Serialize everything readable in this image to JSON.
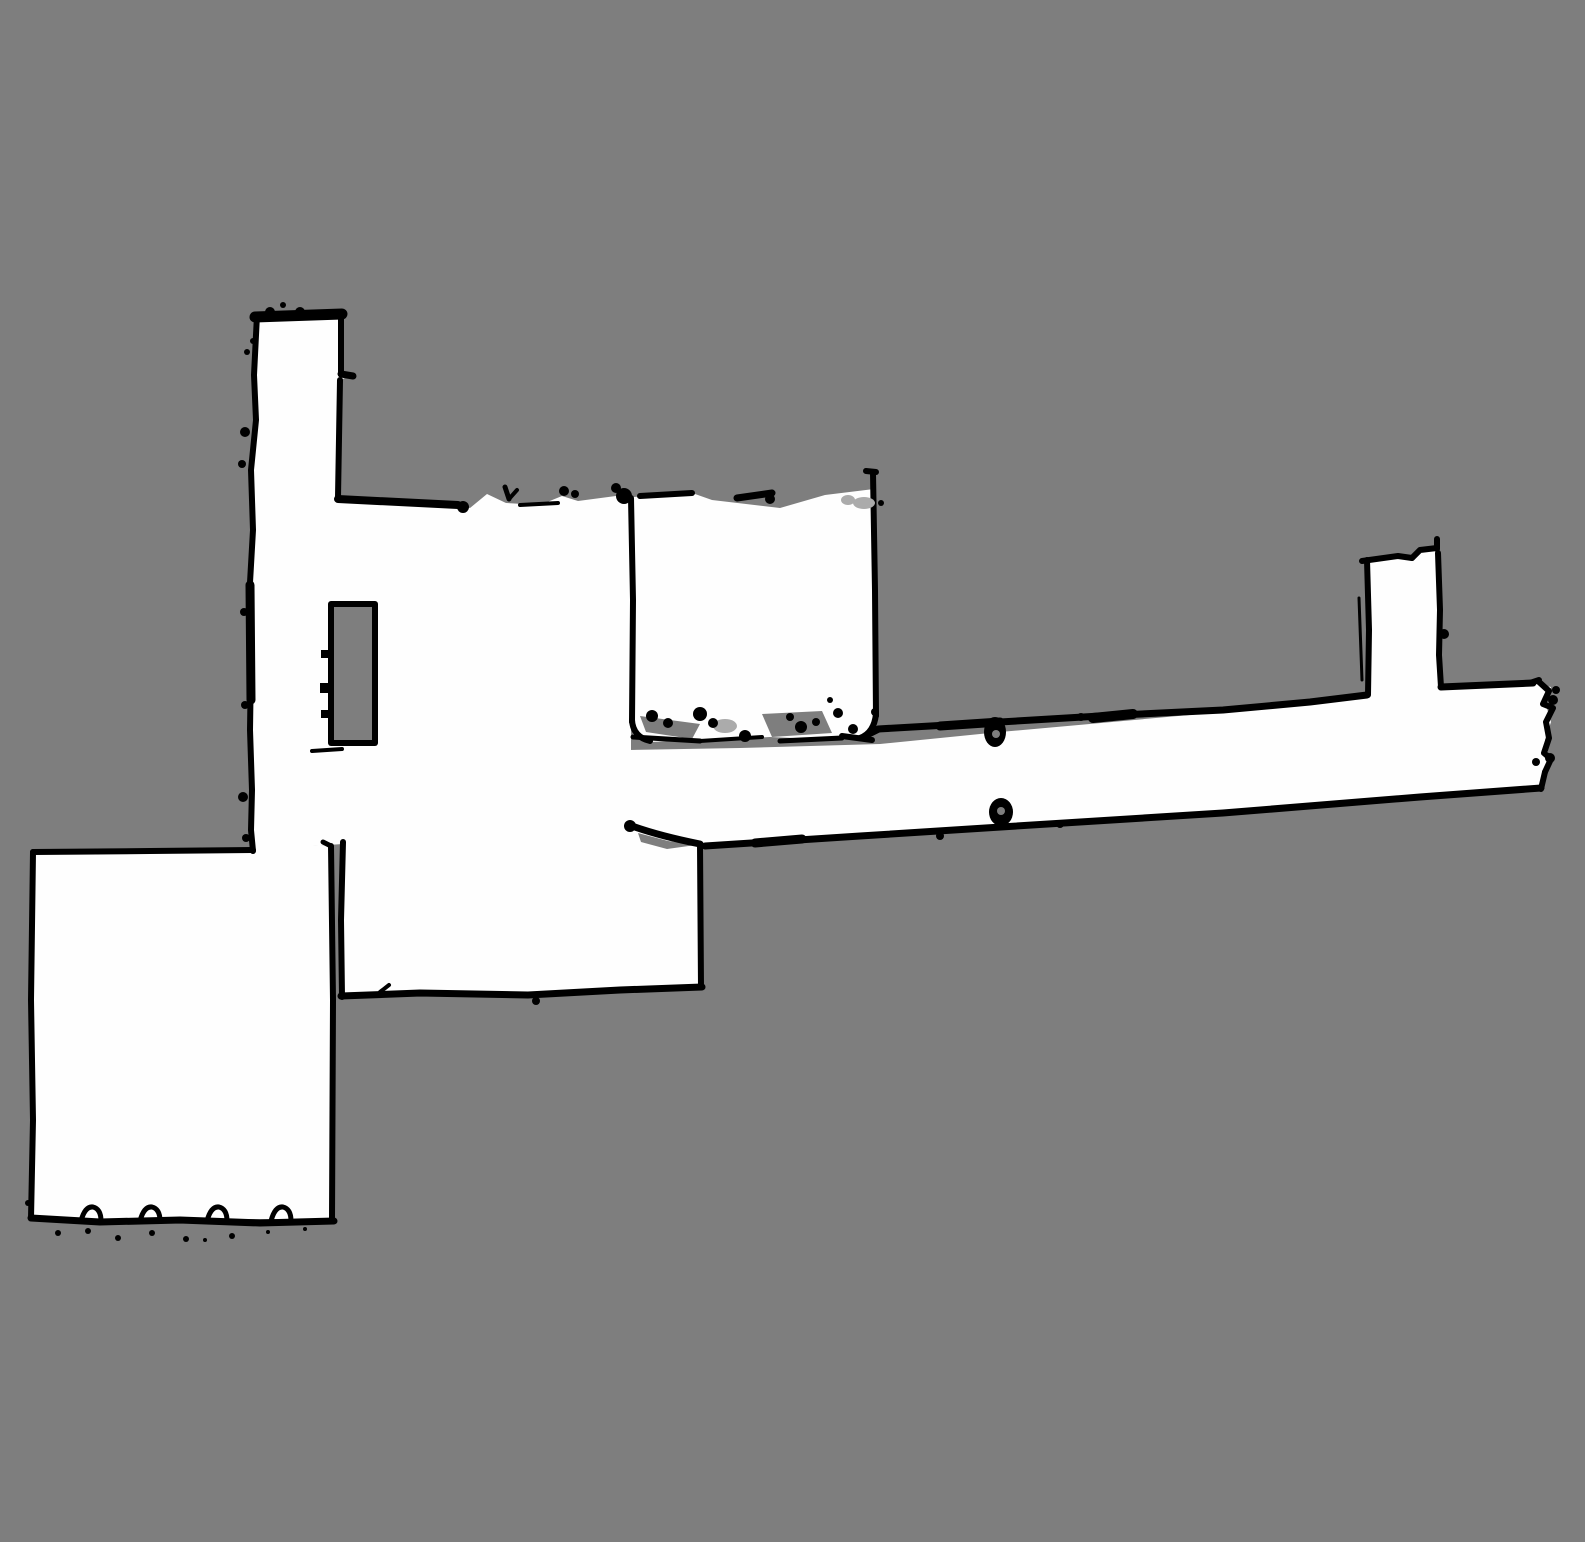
{
  "map": {
    "kind": "slam-occupancy-grid-map",
    "canvas": {
      "width": 1585,
      "height": 1542
    },
    "colors": {
      "unknown": "#7e7e7e",
      "free": "#fefefe",
      "occupied": "#000000",
      "smudge": "#ababab"
    },
    "legend": {
      "unknown": "unknown / unexplored",
      "free": "free space",
      "occupied": "wall / obstacle"
    },
    "regions": [
      {
        "id": "north-corridor",
        "desc": "narrow vertical corridor top-left",
        "bounds_px": "x255-341 y310-497"
      },
      {
        "id": "central-room",
        "desc": "large central free-space room",
        "bounds_px": "x250-633 y490-845"
      },
      {
        "id": "upper-room",
        "desc": "square room right of central room",
        "bounds_px": "x630-877 y472-745"
      },
      {
        "id": "lower-middle-room",
        "desc": "room below central room",
        "bounds_px": "x340-703 y825-997"
      },
      {
        "id": "bottom-left-room",
        "desc": "large rectangular room bottom-left",
        "bounds_px": "x30-334 y845-1222"
      },
      {
        "id": "east-corridor",
        "desc": "long sloping corridor to the right edge",
        "bounds_px": "x630-1552 y680-846"
      },
      {
        "id": "north-alcove",
        "desc": "small vertical alcove above east corridor",
        "bounds_px": "x1358-1444 y538-697"
      },
      {
        "id": "obstacle-island",
        "desc": "rectangular unexplored island in room",
        "bounds_px": "x328-378 y601-746"
      },
      {
        "id": "door-post-1",
        "desc": "small obstacle on corridor top wall",
        "bounds_px": "x985-1007 y718-748"
      },
      {
        "id": "door-post-2",
        "desc": "small obstacle on corridor bottom wall",
        "bounds_px": "x988-1014 y798-827"
      }
    ]
  }
}
